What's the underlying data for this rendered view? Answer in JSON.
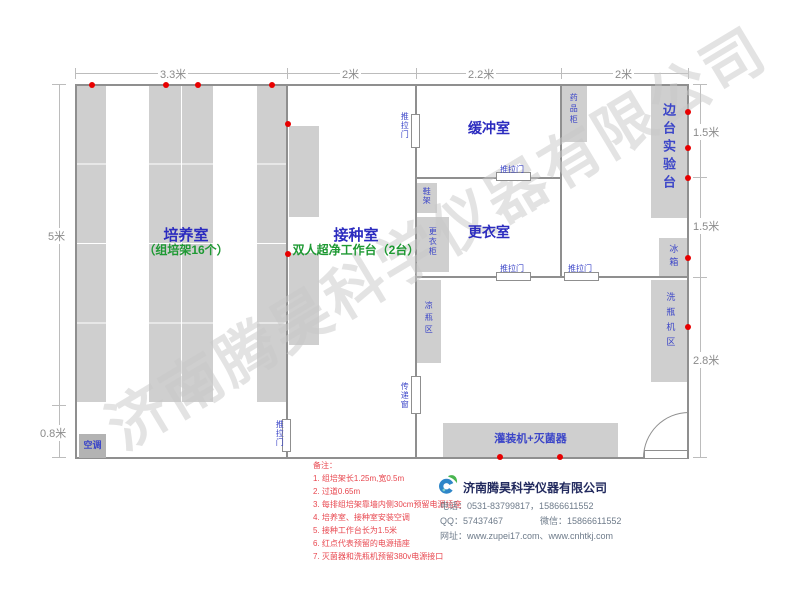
{
  "watermark": "济南腾昊科学仪器有限公司",
  "dims": {
    "top": [
      "3.3米",
      "2米",
      "2.2米",
      "2米"
    ],
    "left": [
      "5米",
      "0.8米"
    ],
    "right": [
      "1.5米",
      "1.5米",
      "2.8米"
    ]
  },
  "rooms": {
    "culture": {
      "name": "培养室",
      "sub": "（组培架16个）"
    },
    "inoculation": {
      "name": "接种室",
      "sub": "双人超净工作台（2台）"
    },
    "buffer": {
      "name": "缓冲室"
    },
    "changing": {
      "name": "更衣室"
    }
  },
  "labels": {
    "sliding_door": "推拉门",
    "pass_window": "传递窗",
    "side_bench": "边台实验台",
    "medicine_cabinet": "药品柜",
    "shoe_rack": "鞋架",
    "wardrobe": "更衣柜",
    "cool_bottle": "凉瓶区",
    "fridge": "冰箱",
    "washer_area": "洗瓶机区",
    "filler": "灌装机+灭菌器",
    "aircon": "空调"
  },
  "notes": {
    "title": "备注：",
    "items": [
      "1. 组培架长1.25m,宽0.5m",
      "2. 过道0.65m",
      "3. 每排组培架靠墙内侧30cm预留电源插座",
      "4. 培养室、接种室安装空调",
      "5. 接种工作台长为1.5米",
      "6. 红点代表预留的电源插座",
      "7. 灭菌器和洗瓶机预留380v电源接口"
    ]
  },
  "company": {
    "name": "济南腾昊科学仪器有限公司",
    "phone": "电话：0531-83799817，15866611552",
    "qq": "QQ：57437467",
    "wechat": "微信：15866611552",
    "website": "网址：www.zupei17.com、www.cnhtkj.com"
  },
  "colors": {
    "wall": "#8f8f8f",
    "furniture": "#cfcfcf",
    "room_label_blue": "#2b2bbf",
    "small_label_blue": "#3c46c8",
    "subtitle_green": "#1e9933",
    "outlet_red": "#e80000",
    "note_red": "#e8474f"
  }
}
